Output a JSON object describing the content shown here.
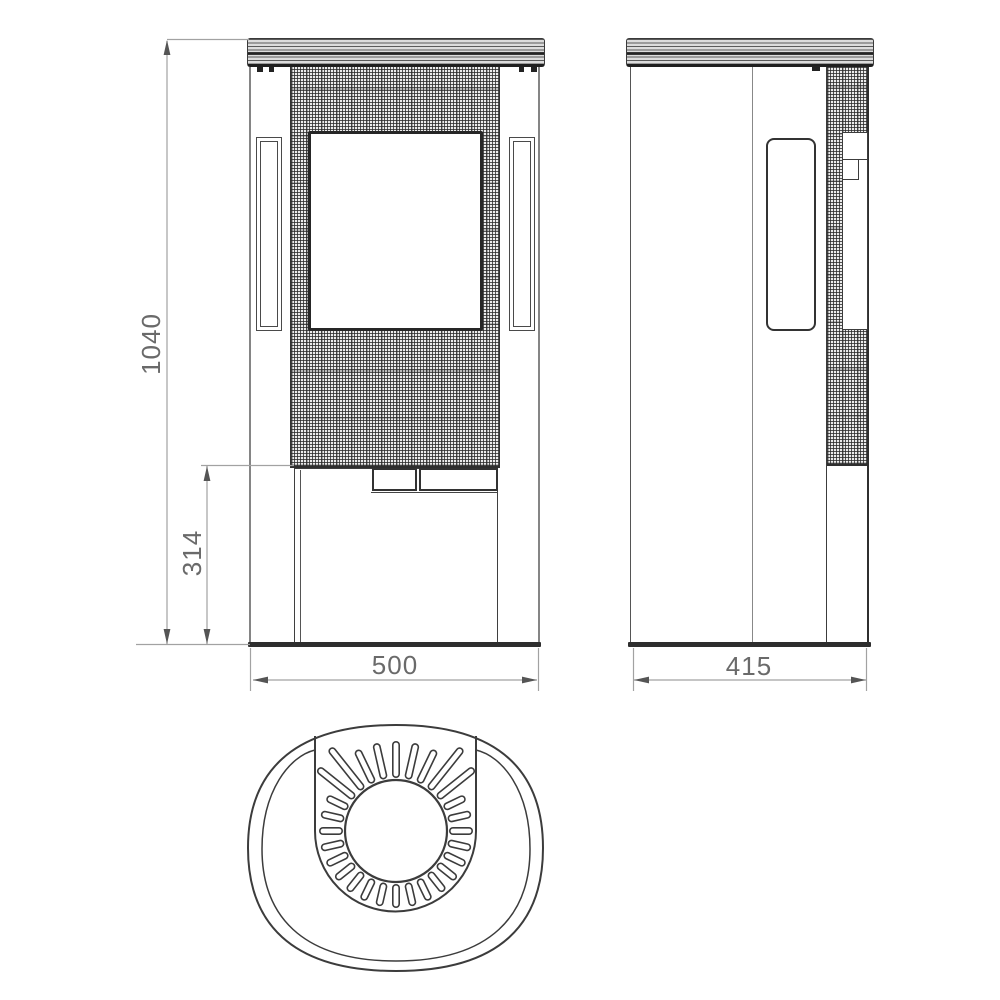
{
  "drawing": {
    "kind": "stove-technical-drawing",
    "views": [
      "front",
      "side",
      "top"
    ]
  },
  "dimensions": {
    "overall_height": "1040",
    "base_height": "314",
    "front_width": "500",
    "side_depth": "415"
  },
  "colors": {
    "line": "#3c3c3c",
    "dim_line": "#a2a2a2",
    "arrow": "#555555",
    "dim_text": "#6a6a6a",
    "background": "#ffffff"
  },
  "top_view": {
    "center_x": 396,
    "center_y": 831,
    "flue_circle_radius": 51,
    "slot_count": 28,
    "slot_inner_radius": 57,
    "slot_outer_radius_default": 73,
    "slot_outer_radius_top": 86,
    "slot_outer_radius_diag_medium": 96,
    "slot_outer_radius_diag_long": 102,
    "slot_width": 8
  }
}
